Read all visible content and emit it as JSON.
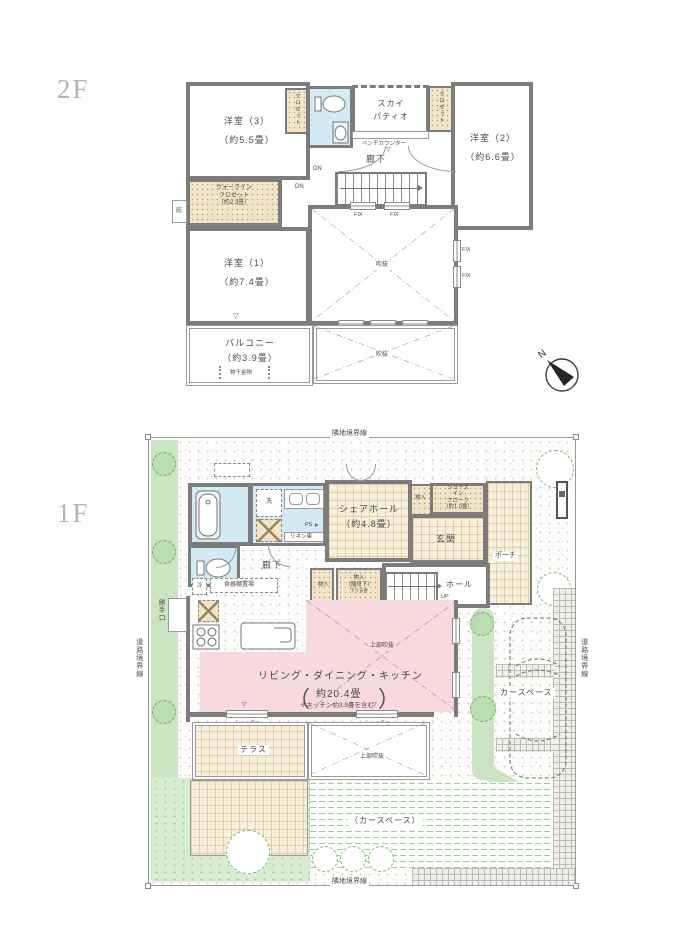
{
  "f2": {
    "floor_label": "2F",
    "rooms": {
      "y3_name": "洋室（3）",
      "y3_size": "（約5.5畳）",
      "y2_name": "洋室（2）",
      "y2_size": "（約6.6畳）",
      "y1_name": "洋室（1）",
      "y1_size": "（約7.4畳）",
      "closet": "クロゼット",
      "sky_line1": "スカイ",
      "sky_line2": "パティオ",
      "wic_line1": "ウォークイン",
      "wic_line2": "クロゼット",
      "wic_line3": "（約2.3畳）",
      "balcony_name": "バルコニー",
      "balcony_size": "（約3.9畳）",
      "rouka": "廊下",
      "fukinuke": "吹抜",
      "hisashi": "庇"
    },
    "marks": {
      "bench": "ベンチカウンター",
      "dn": "DN",
      "fix": "FIX",
      "monohoshi": "物干金物",
      "tri": "▽",
      "north": "N"
    }
  },
  "f1": {
    "floor_label": "1F",
    "site": {
      "rinchi": "隣地境界線",
      "douro": "道路境界線",
      "katteguchi": "勝手口",
      "car_space": "カースペース",
      "car_space_paren": "（カースペース）",
      "terrace": "テラス",
      "joubu": "上部吹抜",
      "shutter": "シャッター"
    },
    "rooms": {
      "share_line1": "シェアホール",
      "share_line2": "（約4.8畳）",
      "genkan": "玄関",
      "porch": "ポーチ",
      "hall": "ホール",
      "rouka": "廊下",
      "sic_line1": "シューズ",
      "sic_line2": "イン",
      "sic_line3": "クローク",
      "sic_line4": "（約1.0畳）",
      "monoire": "物入",
      "kaidan_shita": "（階段下）",
      "sagari_tenjo": "下り天井",
      "ldk_name": "リビング・ダイニング・キッチン",
      "ldk_size": "約20.4畳",
      "ldk_note": "※キッチン約3.8畳を含む",
      "paren_l": "（",
      "paren_r": "）",
      "wash": "洗",
      "rei": "冷",
      "shokki": "食器棚置場",
      "linen": "リネン庫",
      "ps": "PS",
      "up": "UP"
    }
  }
}
